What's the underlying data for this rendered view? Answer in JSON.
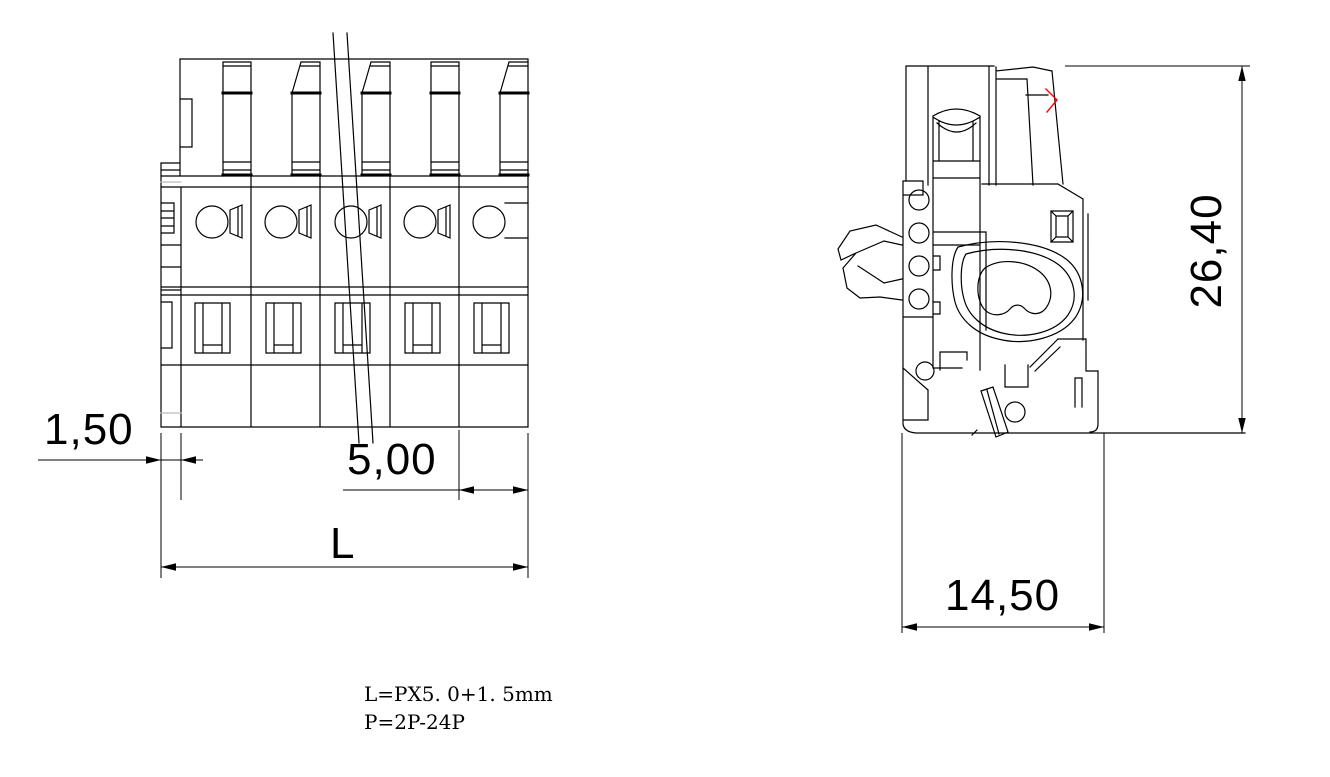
{
  "drawing": {
    "background_color": "#ffffff",
    "line_color": "#000000",
    "highlight_color": "#ff0000",
    "faint_line_color": "#bbbbbb",
    "front_view": {
      "name": "terminal-block-front-view",
      "pole_count": 5
    },
    "side_view": {
      "name": "terminal-block-side-section-view"
    },
    "dimensions": {
      "edge_offset": "1,50",
      "pitch": "5,00",
      "total_length": "L",
      "height": "26,40",
      "depth": "14,50"
    },
    "notes": {
      "line1": "L=PX5. 0+1. 5mm",
      "line2": "P=2P-24P"
    }
  }
}
